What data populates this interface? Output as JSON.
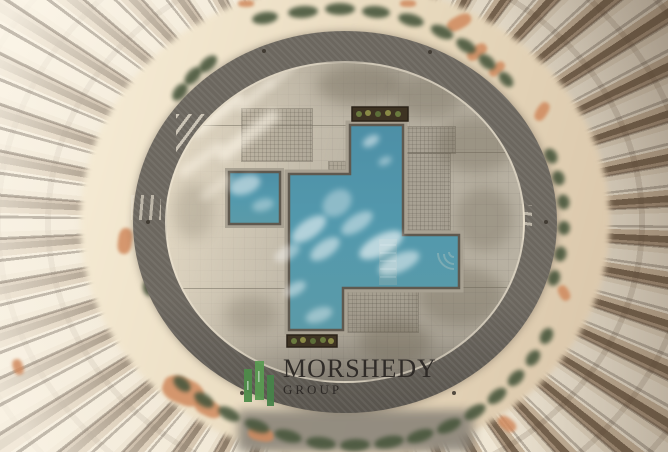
{
  "scene": {
    "description": "Aerial top-down photograph of a circular residential tower courtyard with a stepped freeform swimming pool, grey circular walkway, hedges and radial white balcony fins"
  },
  "watermark": {
    "icon_name": "buildings-bars-icon",
    "title": "MORSHEDY",
    "subtitle": "GROUP",
    "title_color": "#2b2724",
    "icon_color": "#4e8c4a"
  },
  "palette": {
    "pool_water": "#4f95aa",
    "pool_water_light": "#6fb0bf",
    "deck": "#b8b1a2",
    "walkway_ring": "#6c675f",
    "outer_walkway": "#ead9bd",
    "hedge_green": "#49573d",
    "terracotta": "#d08a5e",
    "fin_white": "#efe6d4",
    "fin_shadow": "#77644f",
    "logo_green": "#4e8c4a",
    "logo_green_light": "#5a9a52",
    "logo_text": "#2b2724"
  }
}
